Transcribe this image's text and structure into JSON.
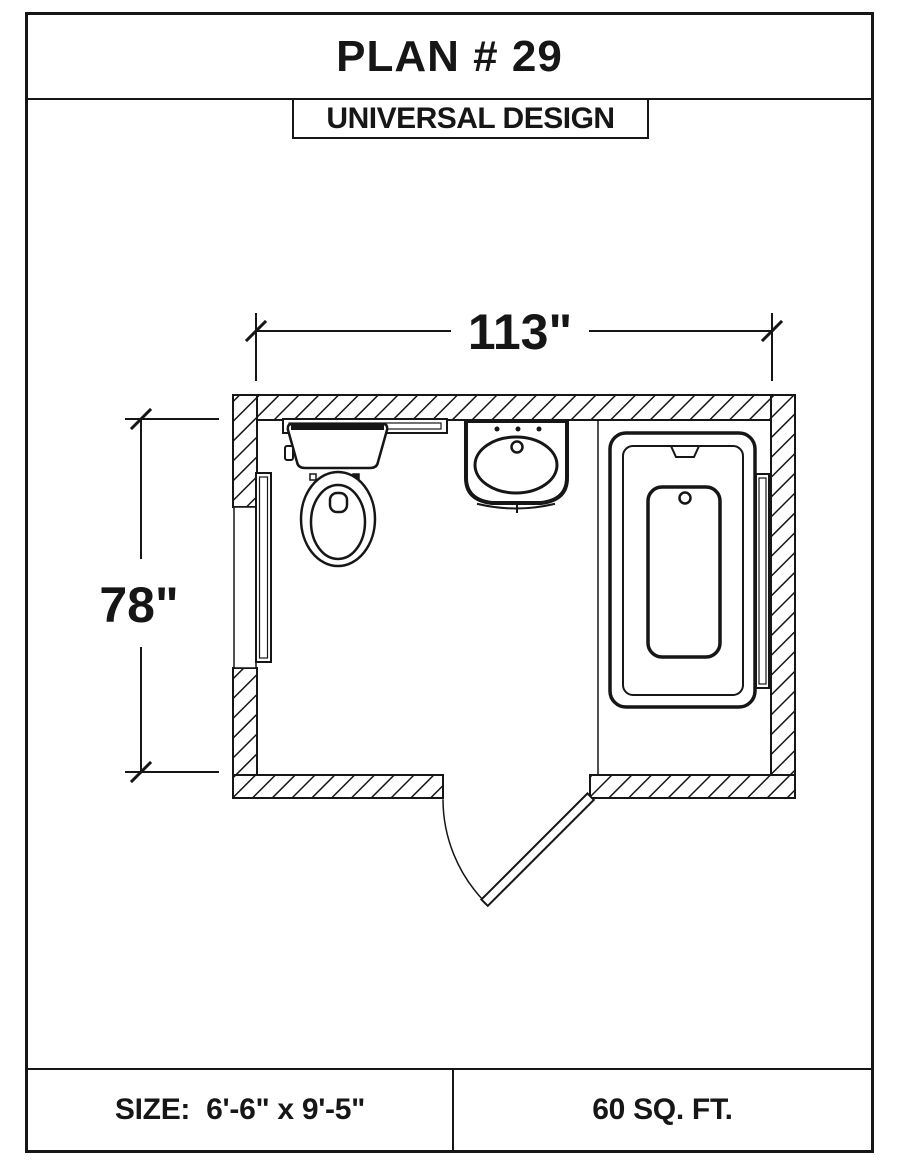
{
  "title": "PLAN # 29",
  "badge": "UNIVERSAL DESIGN",
  "plan": {
    "width_dimension": "113\"",
    "height_dimension": "78\"",
    "fixtures": [
      "toilet",
      "sink",
      "bathtub",
      "grab-bar-left-wall",
      "grab-bar-right-wall",
      "grab-bar-behind-toilet",
      "entry-door"
    ]
  },
  "footer": {
    "size": "SIZE:  6'-6\" x 9'-5\"",
    "area": "60 SQ. FT."
  },
  "colors": {
    "ink": "#161616",
    "paper": "#ffffff"
  }
}
